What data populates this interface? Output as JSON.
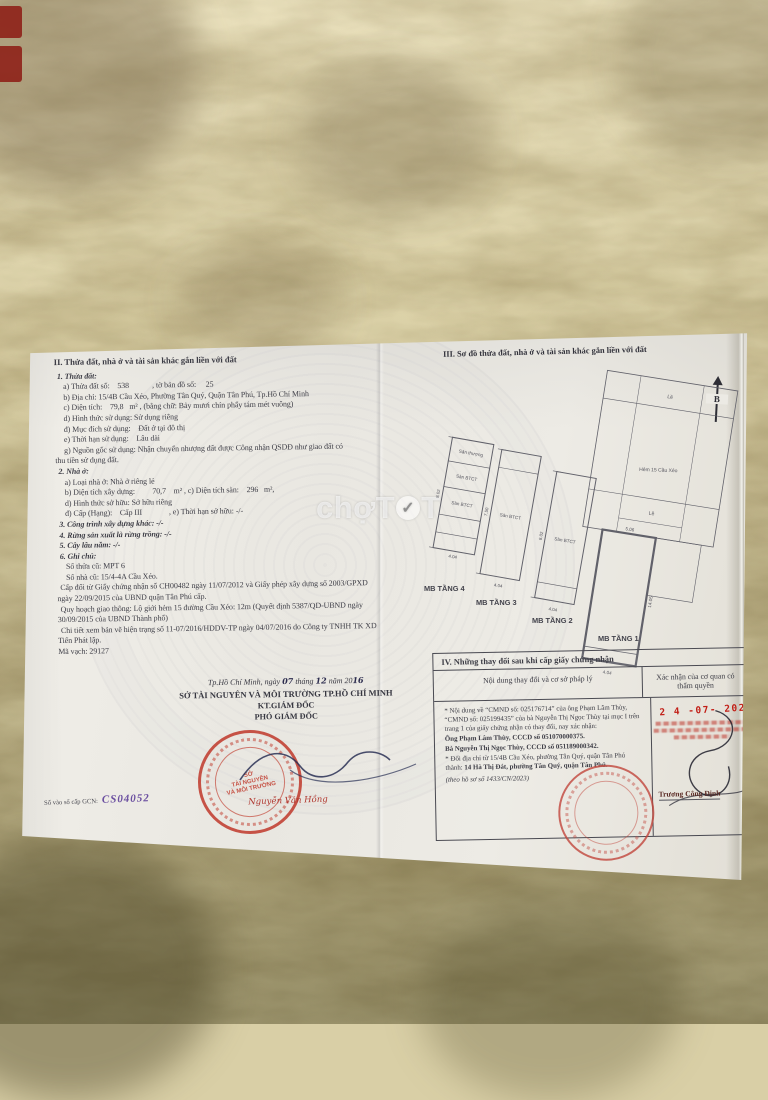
{
  "stickers": {
    "note": "red fragments at photo edge"
  },
  "watermark": {
    "a": "chợ",
    "b": "T",
    "check": "✓",
    "c": "T"
  },
  "doc": {
    "sec2": {
      "lines": [
        "II. Thửa đất, nhà ở và tài sản khác gắn liền với đất",
        "1. Thửa đất:",
        "a) Thửa đất số:    538            , tờ bản đồ số:     25",
        "b) Địa chỉ: 15/4B Cầu Xéo, Phường Tân Quý, Quận Tân Phú, Tp.Hồ Chí Minh",
        "c) Diện tích:    79,8   m² , (bằng chữ: Bảy mươi chín phẩy tám mét vuông)",
        "d) Hình thức sử dụng: Sử dụng riêng",
        "đ) Mục đích sử dụng:    Đất ở tại đô thị",
        "e) Thời hạn sử dụng:    Lâu dài",
        "g) Nguồn gốc sử dụng: Nhận chuyển nhượng đất được Công nhận QSDĐ như giao đất có",
        "thu tiền sử dụng đất.",
        "2. Nhà ở:",
        "a) Loại nhà ở: Nhà ở riêng lẻ",
        "b) Diện tích xây dựng:         70,7    m² , c) Diện tích sàn:    296   m²,",
        "d) Hình thức sở hữu: Sở hữu riêng",
        "đ) Cấp (Hạng):    Cấp III              , e) Thời hạn sở hữu: -/-",
        "3. Công trình xây dựng khác: -/-",
        "4. Rừng sản xuất là rừng trồng: -/-",
        "5. Cây lâu năm: -/-",
        "6. Ghi chú:",
        "Số thửa cũ: MPT 6",
        "Số nhà cũ: 15/4-4A Cầu Xéo.",
        "Cấp đổi từ Giấy chứng nhận số CH00482 ngày 11/07/2012 và Giấy phép xây dựng số 2003/GPXD",
        "ngày 22/09/2015 của UBND quận Tân Phú cấp.",
        "Quy hoạch giao thông: Lộ giới hẻm 15 đường Cầu Xéo: 12m (Quyết định 5387/QD-UBND ngày",
        "30/09/2015 của UBND Thành phố)",
        "Chi tiết xem bản vẽ hiện trạng số 11-07/2016/HDDV-TP ngày 04/07/2016 do Công ty TNHH TK XD",
        "Tiến Phát lập.",
        "Mã vạch: 29127"
      ]
    },
    "sec3": {
      "title": "III. Sơ đồ thửa đất, nhà ở và tài sản khác gắn liền với đất",
      "north": "B",
      "plans": [
        {
          "label": "MB TẦNG 4",
          "cell1": "Sân thượng",
          "cell2": "Sàn BTCT",
          "cell3": "Sàn BTCT",
          "dimA": "8.02",
          "dimB": "4.04"
        },
        {
          "label": "MB TẦNG 3",
          "cell1": "Sàn BTCT",
          "dimA": "7.50",
          "dimB": "4.04"
        },
        {
          "label": "MB TẦNG 2",
          "cell1": "Sàn BTCT",
          "dimA": "8.02",
          "dimB": "4.04"
        },
        {
          "label": "MB TẦNG 1",
          "street": "Hẻm 15 Cầu Xéo",
          "le1": "Lề",
          "le2": "Lề",
          "dimA": "14.05",
          "dimB": "4.04",
          "dimC": "5.06"
        }
      ]
    },
    "sig": {
      "d1": "Tp.Hồ Chí Minh, ngày",
      "d2": "07",
      "d3": "tháng",
      "d4": "12",
      "d5": "năm 20",
      "d6": "16",
      "agency": "SỞ TÀI NGUYÊN VÀ MÔI TRƯỜNG TP.HỒ CHÍ MINH",
      "kt": "KT.GIÁM ĐỐC",
      "deputy": "PHÓ GIÁM ĐỐC",
      "stamp_l1": "SỞ",
      "stamp_l2": "TÀI NGUYÊN",
      "stamp_l3": "VÀ MÔI TRƯỜNG",
      "signer": "Nguyễn Văn Hồng",
      "registry_label": "Số vào sổ cấp GCN:",
      "registry_value": "CS04052"
    },
    "sec4": {
      "title": "IV. Những thay đổi sau khi cấp giấy chứng nhận",
      "col_left": "Nội dung thay đổi và cơ sở pháp lý",
      "col_right": "Xác nhận của cơ quan có thẩm quyền",
      "p1": "* Nội dung về “CMND số: 025176714” của ông Phạm Lâm Thùy, “CMND số: 025199435” của bà Nguyễn Thị Ngọc Thùy tại mục I trên trang 1 của giấy chứng nhận có thay đổi, nay xác nhận:",
      "p2": "Ông Phạm Lâm Thùy, CCCD số 051070000375.",
      "p3": "Bà Nguyễn Thị Ngọc Thùy, CCCD số 051189000342.",
      "p4a": "* Đổi địa chỉ từ 15/4B Cầu Xéo, phường Tân Quý, quận Tân Phú thành: ",
      "p4b": "14 Hà Thị Đát, phường Tân Quý, quận Tân Phú.",
      "p5": "(theo hồ sơ số 1433/CN/2023)",
      "date_stamp": "2 4 -07- 2023",
      "approver": "Trương Công Định"
    }
  }
}
